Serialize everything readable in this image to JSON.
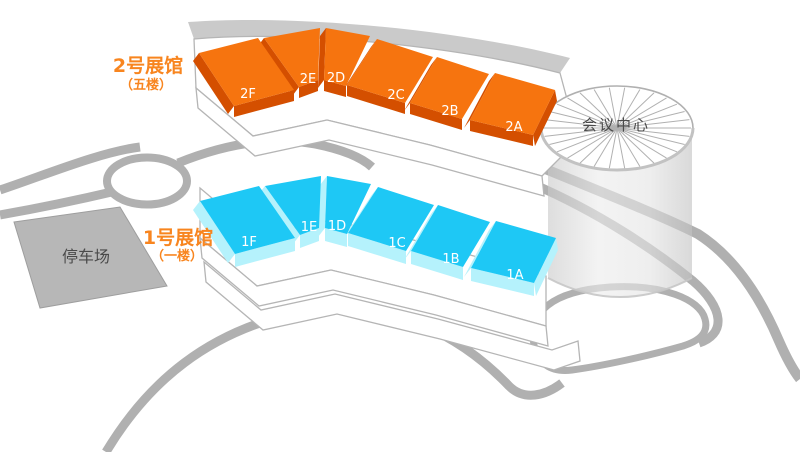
{
  "map_title": "exhibition-center-site-map",
  "hall2": {
    "title": "2号展馆",
    "floor_note": "（五楼）",
    "title_color": "#F8851F",
    "block_top_color": "#F6740F",
    "block_side_color": "#D44F00",
    "blocks": [
      "2F",
      "2E",
      "2D",
      "2C",
      "2B",
      "2A"
    ]
  },
  "hall1": {
    "title": "1号展馆",
    "floor_note": "（一楼）",
    "title_color": "#F8851F",
    "block_top_color": "#1EC8F5",
    "block_side_color": "#B5F2FC",
    "blocks": [
      "1F",
      "1E",
      "1D",
      "1C",
      "1B",
      "1A"
    ]
  },
  "conference_center": {
    "label": "会议中心",
    "text_color": "#4A4A4A"
  },
  "parking": {
    "label": "停车场",
    "text_color": "#4A4A4A",
    "fill": "#B7B7B7"
  },
  "roads": {
    "color": "#B0B0B0"
  },
  "building": {
    "outline_color": "#B5B5B5",
    "roof_band_color": "#CACACA",
    "fill": "#FFFFFF"
  }
}
